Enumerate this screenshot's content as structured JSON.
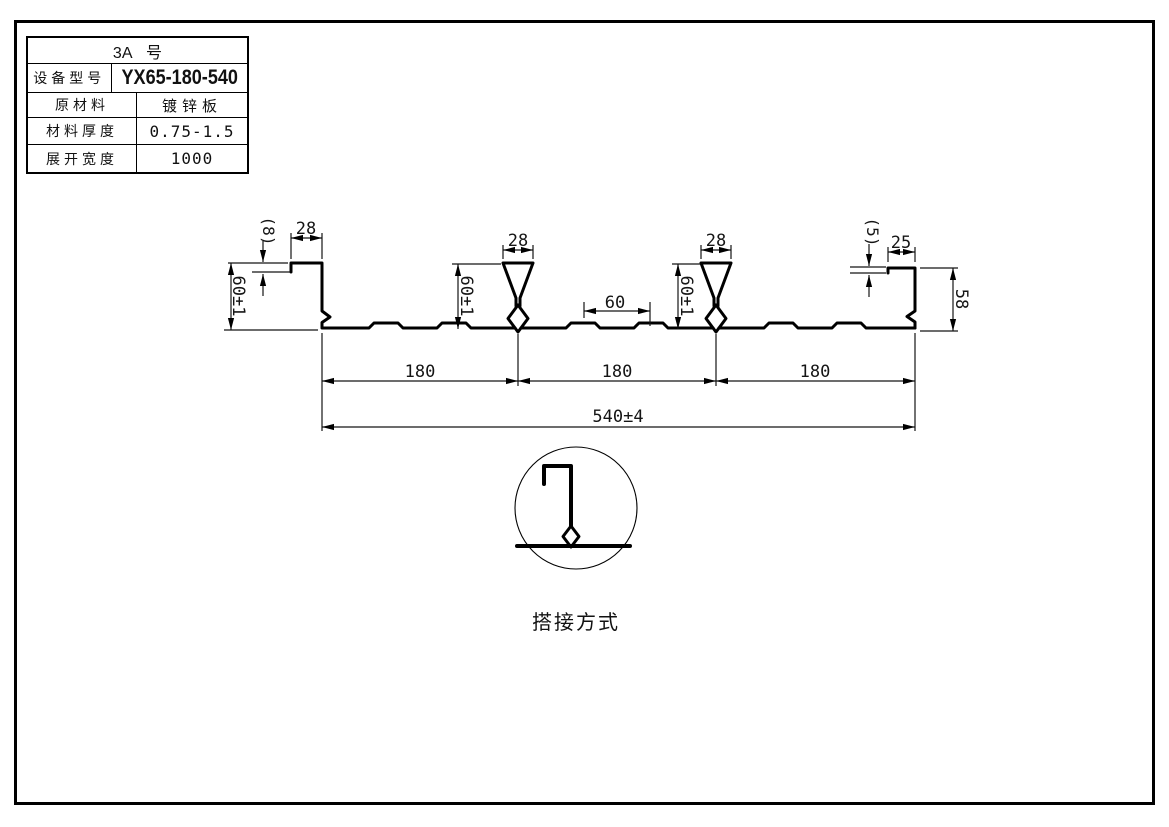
{
  "drawing": {
    "spec_table": {
      "title": "3A 号",
      "rows": [
        {
          "label": "设备型号",
          "value": "YX65-180-540"
        },
        {
          "label": "原材料",
          "value": "镀锌板"
        },
        {
          "label": "材料厚度",
          "value": "0.75-1.5"
        },
        {
          "label": "展开宽度",
          "value": "1000"
        }
      ]
    },
    "profile": {
      "dims": {
        "left_lip": "(8)",
        "left_top_width": "28",
        "left_height": "60±1",
        "rib1_top_width": "28",
        "rib1_height": "60±1",
        "pan_flat": "60",
        "rib2_top_width": "28",
        "rib2_height": "60±1",
        "right_lip": "(5)",
        "right_top_width": "25",
        "right_height": "58",
        "pitch1": "180",
        "pitch2": "180",
        "pitch3": "180",
        "overall_width": "540±4"
      }
    },
    "detail": {
      "caption": "搭接方式"
    },
    "line_color": "#000000",
    "background": "#ffffff"
  }
}
